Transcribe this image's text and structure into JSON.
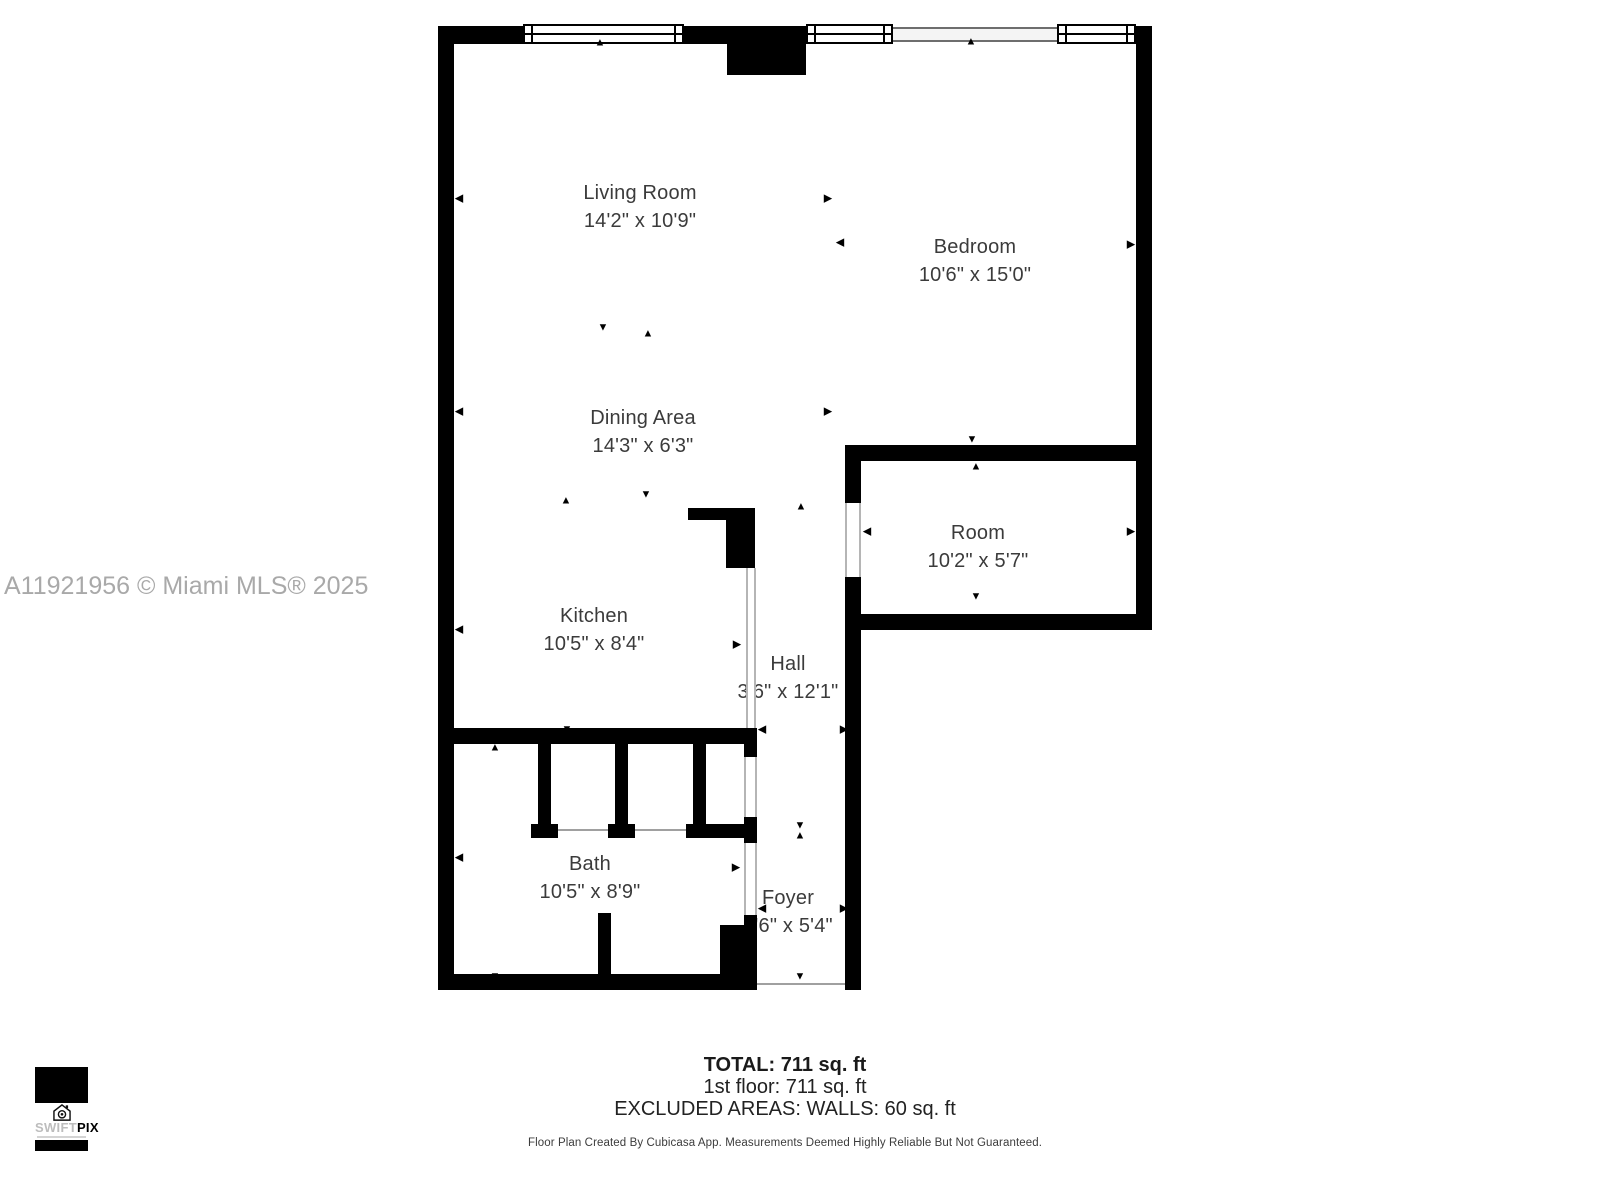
{
  "watermark": {
    "text": "A11921956 © Miami MLS® 2025"
  },
  "floorplan": {
    "rooms": [
      {
        "name": "Living Room",
        "dims": "14'2\" x 10'9\"",
        "cx": 640,
        "cy": 207
      },
      {
        "name": "Bedroom",
        "dims": "10'6\" x 15'0\"",
        "cx": 975,
        "cy": 261
      },
      {
        "name": "Dining Area",
        "dims": "14'3\" x 6'3\"",
        "cx": 643,
        "cy": 432
      },
      {
        "name": "Room",
        "dims": "10'2\" x 5'7\"",
        "cx": 978,
        "cy": 547
      },
      {
        "name": "Kitchen",
        "dims": "10'5\" x 8'4\"",
        "cx": 594,
        "cy": 630
      },
      {
        "name": "Hall",
        "dims": "3'6\" x 12'1\"",
        "cx": 788,
        "cy": 678
      },
      {
        "name": "Bath",
        "dims": "10'5\" x 8'9\"",
        "cx": 590,
        "cy": 878
      },
      {
        "name": "Foyer",
        "dims": "3'6\" x 5'4\"",
        "cx": 788,
        "cy": 912
      }
    ],
    "marker_glyphs": {
      "up": "▲",
      "down": "▼",
      "left": "◀",
      "right": "▶"
    },
    "markers": [
      {
        "dir": "left",
        "x": 459,
        "y": 199
      },
      {
        "dir": "left",
        "x": 459,
        "y": 412
      },
      {
        "dir": "left",
        "x": 459,
        "y": 630
      },
      {
        "dir": "left",
        "x": 459,
        "y": 858
      },
      {
        "dir": "up",
        "x": 600,
        "y": 43
      },
      {
        "dir": "right",
        "x": 828,
        "y": 199
      },
      {
        "dir": "down",
        "x": 603,
        "y": 328
      },
      {
        "dir": "up",
        "x": 648,
        "y": 334
      },
      {
        "dir": "right",
        "x": 828,
        "y": 412
      },
      {
        "dir": "down",
        "x": 646,
        "y": 495
      },
      {
        "dir": "up",
        "x": 566,
        "y": 501
      },
      {
        "dir": "up",
        "x": 971,
        "y": 42
      },
      {
        "dir": "left",
        "x": 840,
        "y": 243
      },
      {
        "dir": "right",
        "x": 1131,
        "y": 245
      },
      {
        "dir": "down",
        "x": 972,
        "y": 440
      },
      {
        "dir": "up",
        "x": 976,
        "y": 467
      },
      {
        "dir": "down",
        "x": 976,
        "y": 597
      },
      {
        "dir": "left",
        "x": 867,
        "y": 532
      },
      {
        "dir": "right",
        "x": 1131,
        "y": 532
      },
      {
        "dir": "up",
        "x": 801,
        "y": 507
      },
      {
        "dir": "right",
        "x": 737,
        "y": 645
      },
      {
        "dir": "down",
        "x": 567,
        "y": 730
      },
      {
        "dir": "up",
        "x": 495,
        "y": 748
      },
      {
        "dir": "left",
        "x": 762,
        "y": 730
      },
      {
        "dir": "right",
        "x": 844,
        "y": 730
      },
      {
        "dir": "down",
        "x": 800,
        "y": 826
      },
      {
        "dir": "up",
        "x": 800,
        "y": 836
      },
      {
        "dir": "right",
        "x": 736,
        "y": 868
      },
      {
        "dir": "left",
        "x": 762,
        "y": 909
      },
      {
        "dir": "right",
        "x": 844,
        "y": 909
      },
      {
        "dir": "down",
        "x": 495,
        "y": 977
      },
      {
        "dir": "down",
        "x": 800,
        "y": 977
      }
    ]
  },
  "summary": {
    "total": "TOTAL: 711 sq. ft",
    "first_floor": "1st floor: 711 sq. ft",
    "excluded": "EXCLUDED AREAS: WALLS: 60 sq. ft",
    "disclaimer": "Floor Plan Created By Cubicasa App. Measurements Deemed Highly Reliable But Not Guaranteed."
  },
  "logo": {
    "icon": "house-camera-icon",
    "name_light": "SWIFT",
    "name_bold": "PIX"
  },
  "colors": {
    "wall": "#000000",
    "label": "#3b3b3b",
    "watermark": "#a9a9a9"
  }
}
